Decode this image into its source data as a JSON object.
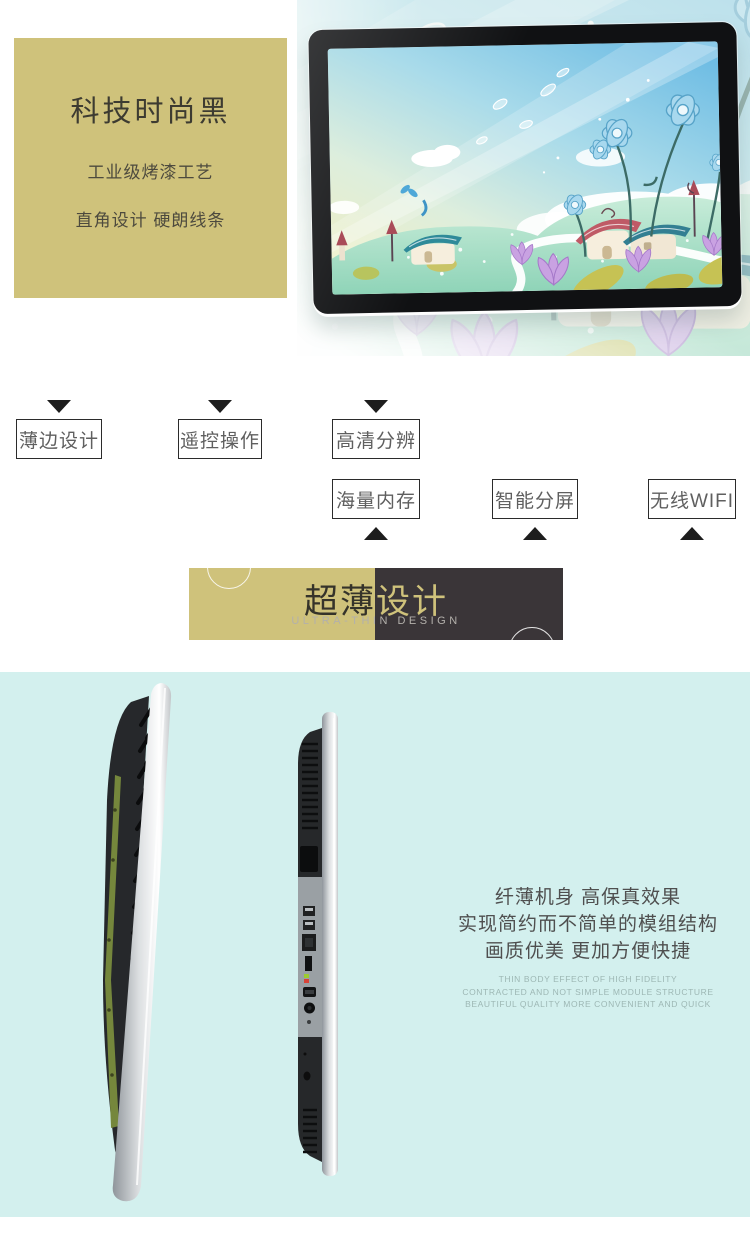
{
  "page": {
    "width": 750,
    "height": 1235,
    "background": "#ffffff"
  },
  "colors": {
    "gold": "#cfc27b",
    "banner_dark": "#3a3538",
    "cyan_background": "#d3f0ee",
    "tag_border": "#2b2b2b",
    "tag_text": "#5f5f5f",
    "panel_text": "#3d3b31",
    "cn_text": "#4f4f4f",
    "en_text": "#9db7b4"
  },
  "hero": {
    "panel": {
      "title": "科技时尚黑",
      "line1": "工业级烤漆工艺",
      "line2": "直角设计 硬朗线条"
    }
  },
  "features": {
    "row1": [
      {
        "label": "薄边设计"
      },
      {
        "label": "遥控操作"
      },
      {
        "label": "高清分辨"
      }
    ],
    "row2": [
      {
        "label": "海量内存"
      },
      {
        "label": "智能分屏"
      },
      {
        "label": "无线WIFI"
      }
    ]
  },
  "banner": {
    "title_left": "超薄",
    "title_right": "设计",
    "subtitle": "ULTRA-THIN DESIGN"
  },
  "thin_section": {
    "cn_lines": [
      "纤薄机身 高保真效果",
      "实现简约而不简单的模组结构",
      "画质优美 更加方便快捷"
    ],
    "en_lines": [
      "THIN BODY EFFECT OF HIGH FIDELITY",
      "CONTRACTED AND NOT SIMPLE MODULE STRUCTURE",
      "BEAUTIFUL QUALITY MORE CONVENIENT AND QUICK"
    ]
  }
}
